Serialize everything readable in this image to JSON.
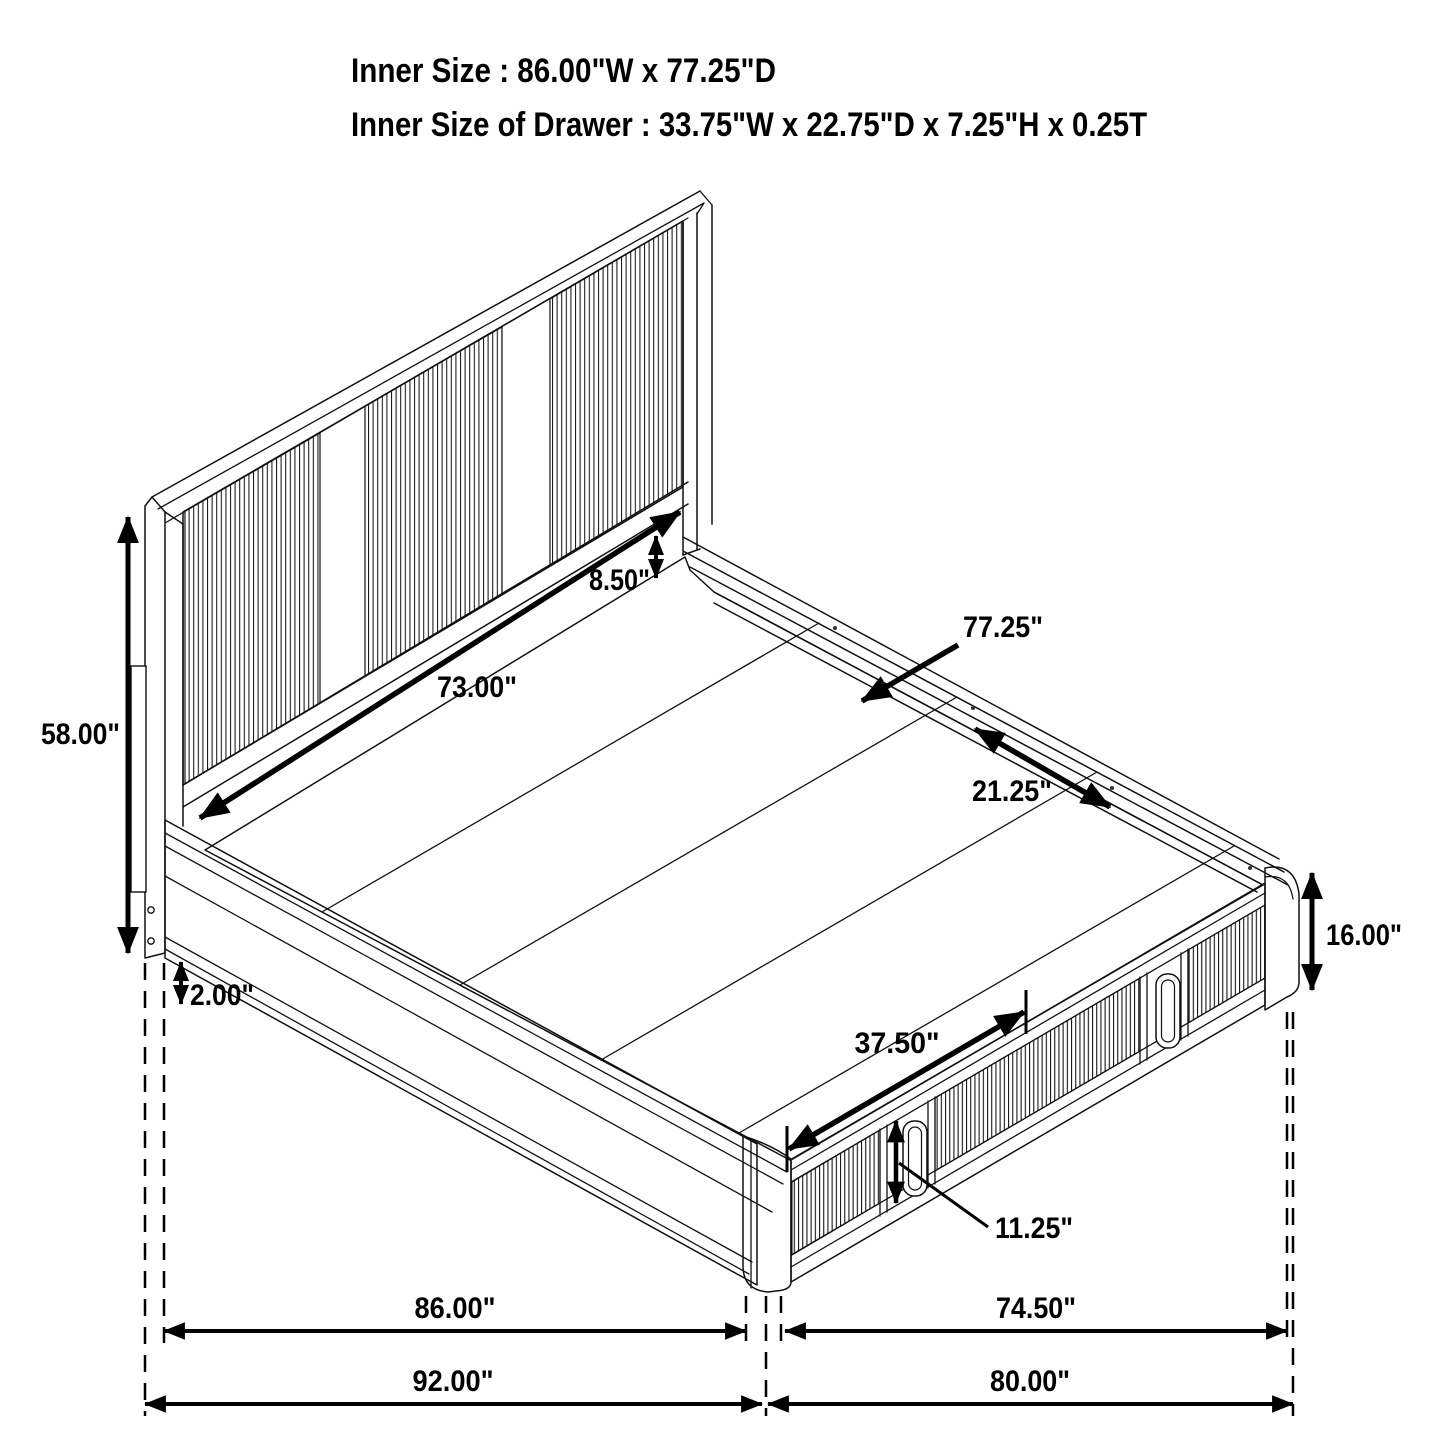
{
  "title": {
    "line1": "Inner Size : 86.00\"W x 77.25\"D",
    "line2": "Inner Size of Drawer : 33.75\"W x 22.75\"D x 7.25\"H x 0.25T"
  },
  "dimensions": {
    "headboard_height": "58.00\"",
    "frame_bottom_gap": "2.00\"",
    "headboard_inner_width": "73.00\"",
    "headboard_panel_gap": "8.50\"",
    "inner_depth": "77.25\"",
    "rail_board_width": "21.25\"",
    "base_height": "16.00\"",
    "drawer_front_width": "37.50\"",
    "drawer_opening_height": "11.25\"",
    "inner_width": "86.00\"",
    "footside_inner_length": "74.50\"",
    "overall_width": "92.00\"",
    "overall_length": "80.00\""
  },
  "colors": {
    "line": "#111111",
    "dimension": "#000000",
    "background": "#ffffff"
  }
}
